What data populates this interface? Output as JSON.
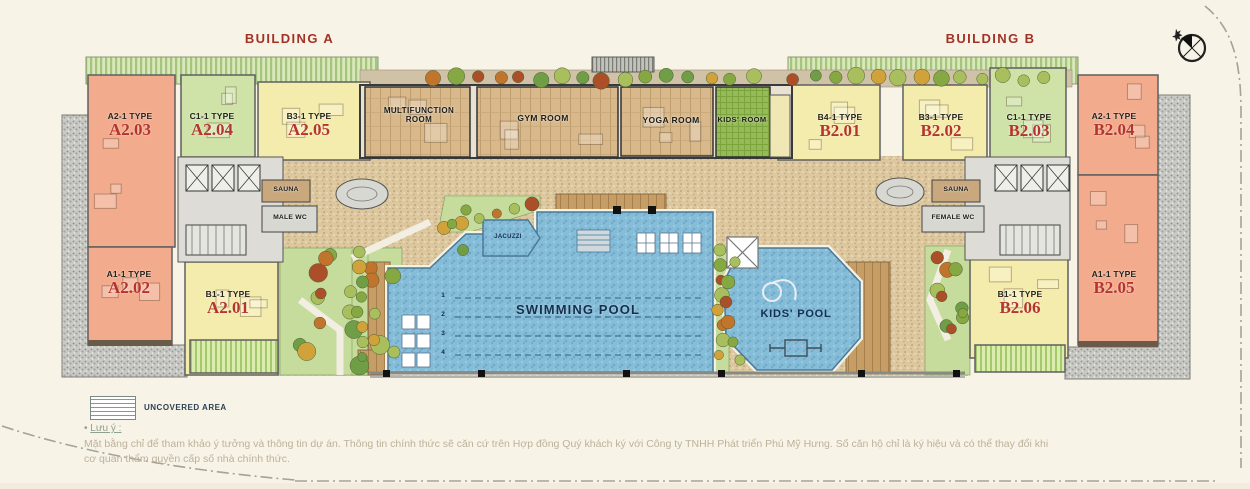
{
  "titles": {
    "building_a": "BUILDING A",
    "building_b": "BUILDING B"
  },
  "units": [
    {
      "key": "a2_03",
      "type_label": "A2-1 TYPE",
      "code": "A2.03"
    },
    {
      "key": "a2_04",
      "type_label": "C1-1 TYPE",
      "code": "A2.04"
    },
    {
      "key": "a2_05",
      "type_label": "B3-1 TYPE",
      "code": "A2.05"
    },
    {
      "key": "a2_02",
      "type_label": "A1-1 TYPE",
      "code": "A2.02"
    },
    {
      "key": "a2_01",
      "type_label": "B1-1 TYPE",
      "code": "A2.01"
    },
    {
      "key": "b2_01",
      "type_label": "B4-1 TYPE",
      "code": "B2.01"
    },
    {
      "key": "b2_02",
      "type_label": "B3-1 TYPE",
      "code": "B2.02"
    },
    {
      "key": "b2_03",
      "type_label": "C1-1 TYPE",
      "code": "B2.03"
    },
    {
      "key": "b2_04",
      "type_label": "A2-1 TYPE",
      "code": "B2.04"
    },
    {
      "key": "b2_05",
      "type_label": "A1-1 TYPE",
      "code": "B2.05"
    },
    {
      "key": "b2_06",
      "type_label": "B1-1 TYPE",
      "code": "B2.06"
    }
  ],
  "amenities": {
    "multifunction": "MULTIFUNCTION ROOM",
    "gym": "GYM ROOM",
    "yoga": "YOGA ROOM",
    "kids_room": "KIDS' ROOM",
    "sauna_a": "SAUNA",
    "male_wc": "MALE WC",
    "sauna_b": "SAUNA",
    "female_wc": "FEMALE WC",
    "jacuzzi": "JACUZZI",
    "swimming_pool": "SWIMMING POOL",
    "kids_pool": "KIDS' POOL",
    "lanes": [
      "1",
      "2",
      "3",
      "4"
    ]
  },
  "legend": {
    "uncovered_area": "UNCOVERED AREA"
  },
  "notes": {
    "bullet": "•",
    "label": "Lưu ý :",
    "line1": "Mặt bằng chỉ để tham khảo ý tưởng và thông tin dự án. Thông tin chính thức sẽ căn cứ trên Hợp đồng Quý khách ký với Công ty TNHH Phát triển Phú Mỹ Hưng. Số căn hộ chỉ là ký hiệu và có thể thay đổi khi",
    "line2": "cơ quan thẩm quyền cấp số nhà chính thức."
  },
  "colors": {
    "title_red": "#a33226",
    "code_red": "#b5352c",
    "unit_salmon": "#f2ab8d",
    "unit_green": "#cfe3a8",
    "unit_yellow": "#f4ecac",
    "kids_room_green": "#8fb954",
    "pool_blue": "#85bcd8",
    "wood": "#d7b78a",
    "pavement": "#dcc79f",
    "uncovered_gray": "#c9c9c5",
    "legend_green": "#5fae8c"
  }
}
